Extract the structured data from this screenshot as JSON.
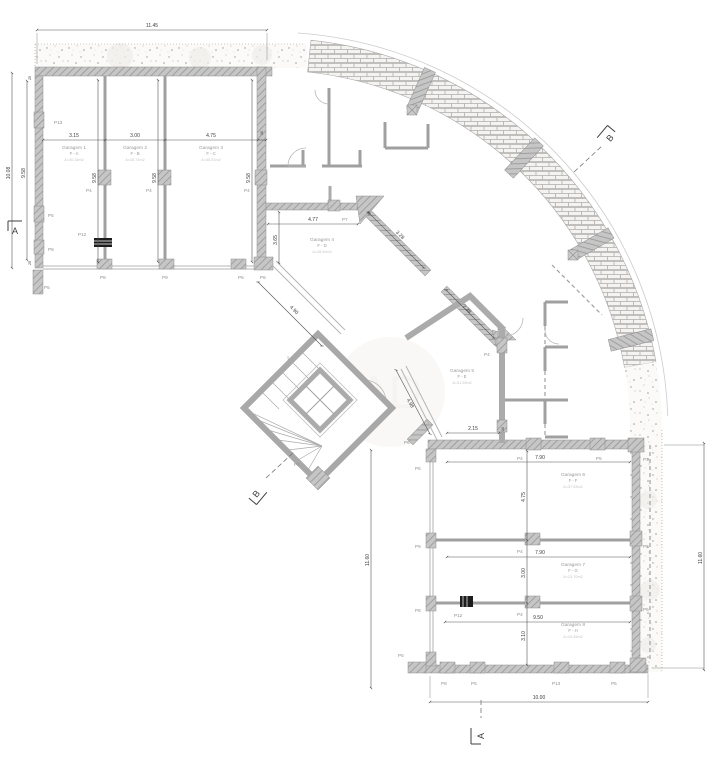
{
  "drawing": {
    "type": "architectural-floor-plan-garage-level",
    "sections": {
      "a": "A",
      "b": "B"
    },
    "dims": {
      "top_width": "11.45",
      "left_outer": "10.08",
      "left_inner": "9.58",
      "wall_25_top": "25",
      "wall_25_bottom": "25",
      "g1_w": "3.15",
      "g2_w": "3.00",
      "g3_w": "4.75",
      "g3_end": "30",
      "g1_h": "9.58",
      "g2_h": "9.58",
      "g3_h": "9.58",
      "g4_w": "4.77",
      "g4_h": "3.65",
      "g4_front": "4.90",
      "corridor_a": "3.28",
      "corridor_b": "2.38",
      "corridor_small": "30",
      "g5_front": "4.98",
      "rw_entry": "2.15",
      "rw_entry_small": "30",
      "g6_w": "7.90",
      "g6_h": "4.75",
      "g7_w": "7.90",
      "g7_h": "3.00",
      "g8_w": "9.50",
      "g8_h": "3.10",
      "bottom_width": "10.00",
      "right_height": "11.60",
      "mid_height": "11.60"
    },
    "garages": [
      {
        "name": "Garagem 1",
        "code": "F - A",
        "area": "A=30.18m2"
      },
      {
        "name": "Garagem 2",
        "code": "F - B",
        "area": "A=28.74m2"
      },
      {
        "name": "Garagem 3",
        "code": "F - C",
        "area": "A=45.51m2"
      },
      {
        "name": "Garagem 4",
        "code": "F - D",
        "area": "A=28.40m2"
      },
      {
        "name": "Garagem 5",
        "code": "F - E",
        "area": "A=31.25m2"
      },
      {
        "name": "Garagem 6",
        "code": "F - F",
        "area": "A=37.53m2"
      },
      {
        "name": "Garagem 7",
        "code": "F - G",
        "area": "A=23.70m2"
      },
      {
        "name": "Garagem 8",
        "code": "F - H",
        "area": "A=29.45m2"
      }
    ],
    "columns": [
      "P13",
      "P5",
      "P8",
      "P5",
      "P4",
      "P4",
      "P4",
      "P12",
      "P8",
      "P9",
      "P6",
      "P6",
      "P7",
      "P2",
      "P4",
      "P4",
      "P5",
      "P3",
      "P6",
      "P9",
      "P8",
      "P5",
      "P6",
      "P4",
      "P4",
      "P12",
      "P8",
      "P5",
      "P13",
      "P5",
      "P5",
      "P6"
    ],
    "colors": {
      "wall_fill": "#c6c6c6",
      "wall_hatch": "#969696",
      "brick_line": "#b0aeab",
      "dim_line": "#555555",
      "label_gray": "#9a9a9a"
    }
  }
}
